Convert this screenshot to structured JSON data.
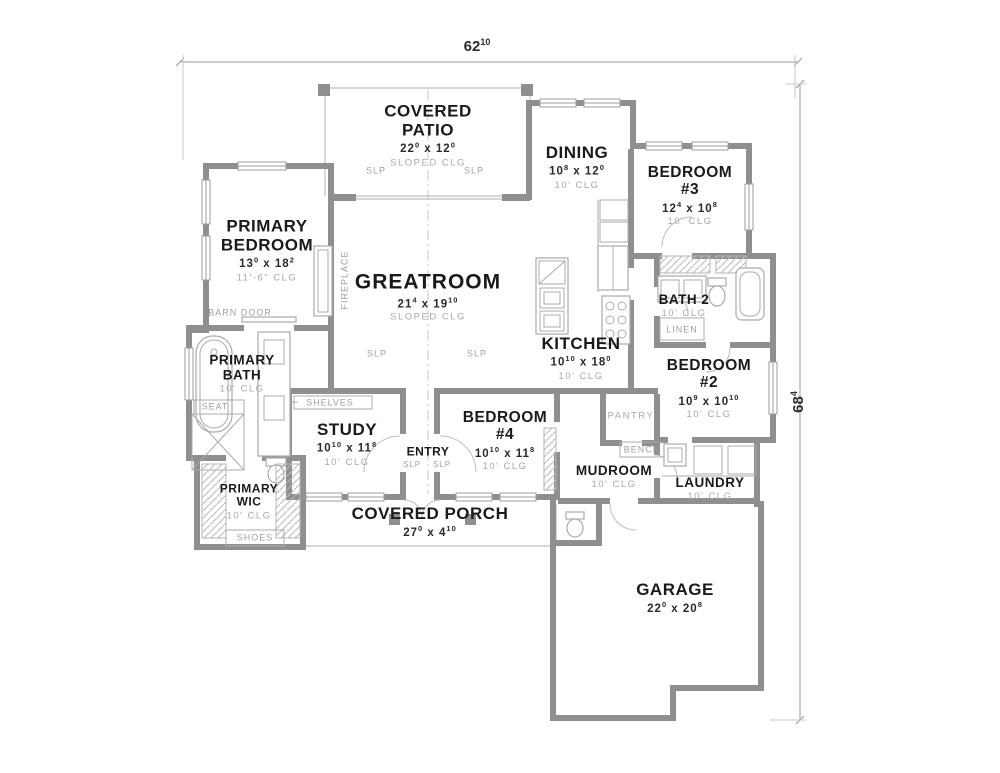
{
  "dimensions": {
    "width": "62^10",
    "height": "68^4"
  },
  "rooms": {
    "covered_patio": {
      "name": "COVERED PATIO",
      "dim": "22^0 x 12^0",
      "clg": "SLOPED CLG"
    },
    "dining": {
      "name": "DINING",
      "dim": "10^8 x 12^0",
      "clg": "10' CLG"
    },
    "bedroom3": {
      "name": "BEDROOM #3",
      "dim": "12^4 x 10^8",
      "clg": "10' CLG"
    },
    "primary_bedroom": {
      "name": "PRIMARY BEDROOM",
      "dim": "13^0 x 18^2",
      "clg": "11'-6\" CLG"
    },
    "greatroom": {
      "name": "GREATROOM",
      "dim": "21^4 x 19^10",
      "clg": "SLOPED CLG"
    },
    "kitchen": {
      "name": "KITCHEN",
      "dim": "10^10 x 18^0",
      "clg": "10' CLG"
    },
    "bath2": {
      "name": "BATH 2",
      "clg": "10' CLG"
    },
    "bedroom2": {
      "name": "BEDROOM #2",
      "dim": "10^9 x 10^10",
      "clg": "10' CLG"
    },
    "primary_bath": {
      "name": "PRIMARY BATH",
      "clg": "10' CLG"
    },
    "study": {
      "name": "STUDY",
      "dim": "10^10 x 11^8",
      "clg": "10' CLG"
    },
    "entry": {
      "name": "ENTRY"
    },
    "bedroom4": {
      "name": "BEDROOM #4",
      "dim": "10^10 x 11^8",
      "clg": "10' CLG"
    },
    "pantry": {
      "name": "PANTRY"
    },
    "mudroom": {
      "name": "MUDROOM",
      "clg": "10' CLG"
    },
    "laundry": {
      "name": "LAUNDRY",
      "clg": "10' CLG"
    },
    "primary_wic": {
      "name": "PRIMARY WIC",
      "clg": "10' CLG"
    },
    "covered_porch": {
      "name": "COVERED PORCH",
      "dim": "27^0 x 4^10"
    },
    "garage": {
      "name": "GARAGE",
      "dim": "22^0 x 20^8"
    }
  },
  "features": {
    "fireplace": "FIREPLACE",
    "barn_door": "BARN DOOR",
    "shelves": "SHELVES",
    "seat": "SEAT",
    "shoes": "SHOES",
    "linen": "LINEN",
    "bench": "BENCH",
    "slp": "SLP"
  },
  "colors": {
    "wall": "#8f8f8f",
    "thin_line": "#bdbdbd",
    "label_text": "#1a1a1a",
    "muted_text": "#a8a8a8",
    "background": "#ffffff"
  }
}
